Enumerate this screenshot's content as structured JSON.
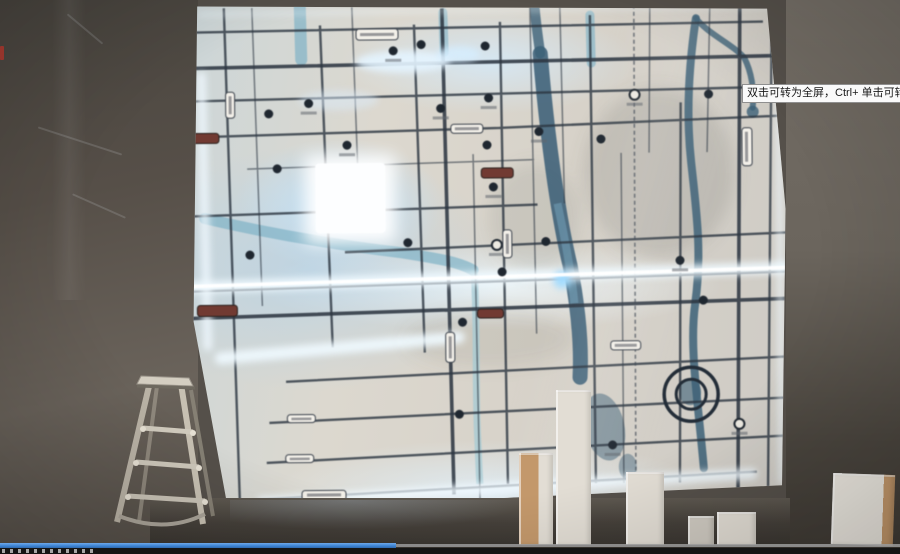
{
  "tooltip": {
    "text": "双击可转为全屏，Ctrl+ 单击可转为"
  },
  "player": {
    "progress_percent": 44
  },
  "scene": {
    "colors": {
      "wall_left": "#5b554e",
      "wall_right": "#6e6961",
      "wall_dark_bottom": "#3c3833",
      "map_base": "#d9d4cb",
      "map_glow": "#bfe0f7",
      "road": "#2d3742",
      "river": "#3c6077",
      "river_light": "#7fb2c6",
      "led": "#f0f9ff",
      "label_maroon": "#713a32",
      "ladder_metal": "#c2bbae",
      "block_white": "#e2ddd4",
      "block_tan": "#c3986b",
      "progress_blue": "#3f86d6",
      "progress_track": "#9a9a9a",
      "controls_bg": "#141414",
      "tooltip_bg": "#fafafa",
      "tooltip_border": "#8f8f8f",
      "tooltip_text": "#1a1a1a"
    }
  }
}
